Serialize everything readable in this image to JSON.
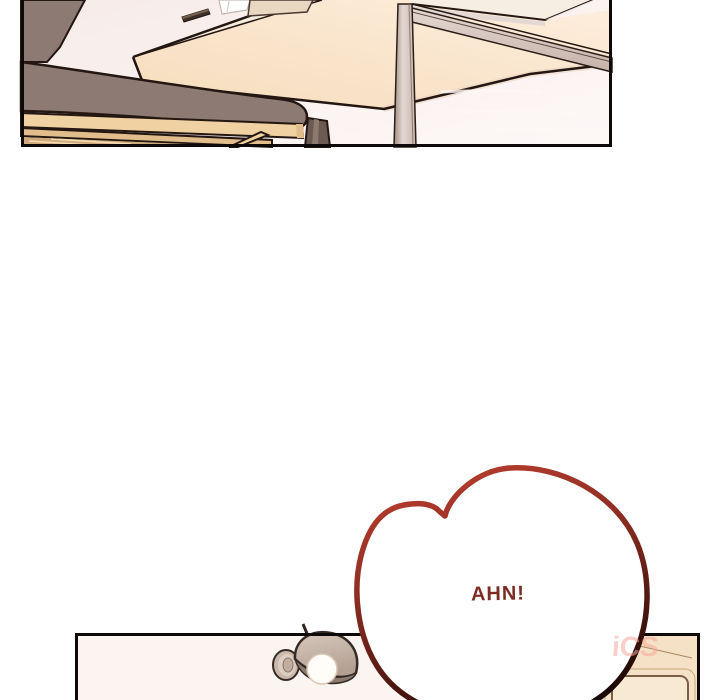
{
  "page": {
    "width": 720,
    "height": 700,
    "background": "#ffffff"
  },
  "speech_bubble": {
    "text": "AHN!"
  },
  "watermark": {
    "text": "iCS"
  },
  "colors": {
    "pagebg": "#ffffff",
    "ink": "#241712",
    "borderink": "#0d0908",
    "wall": "#f6ebe7",
    "wall2": "#fbf3f1",
    "cream": "#f9e3ca",
    "creamlight": "#fdeedd",
    "creamdark": "#f6dcbc",
    "creamsliver": "#f5ecdc",
    "shelfpale": "#f7eee3",
    "taupe": "#8d7a73",
    "wood": "#efd1a2",
    "wood2": "#e2bd8c",
    "wood3": "#cfa97c",
    "woodhi": "#f3dcb2",
    "metal": "#c6b3aa",
    "metalhi": "#e4d8d2",
    "metallow": "#a08b81",
    "darkpost": "#6b5a52",
    "darkposthi": "#8d7a6e",
    "paper": "#ffffff",
    "beige": "#e9d8c1",
    "clip": "#3d2f28",
    "cliphi": "#75604f",
    "wallb": "#fcf4f1",
    "door": "#f5e2c6",
    "doorpanel": "#f8e9d3",
    "doorline": "#7a5f45",
    "doorline2": "#c8a87c",
    "mount": "#cbb8aa",
    "mount2": "#dccdc2",
    "mount3": "#c1ae9f",
    "dometop": "#d8c9bd",
    "domebase": "#b3a093",
    "domeshadow": "#8d7a6e",
    "bulb": "#fffdf7",
    "bubblefill": "#ffffff",
    "bubbletop": "#b23b2c",
    "bubblemid": "#8c2d23",
    "bubblelow": "#4a170f",
    "bubbledark": "#140604",
    "textred": "#7d2c24",
    "wmcolor": "rgba(244,168,155,0.55)"
  }
}
